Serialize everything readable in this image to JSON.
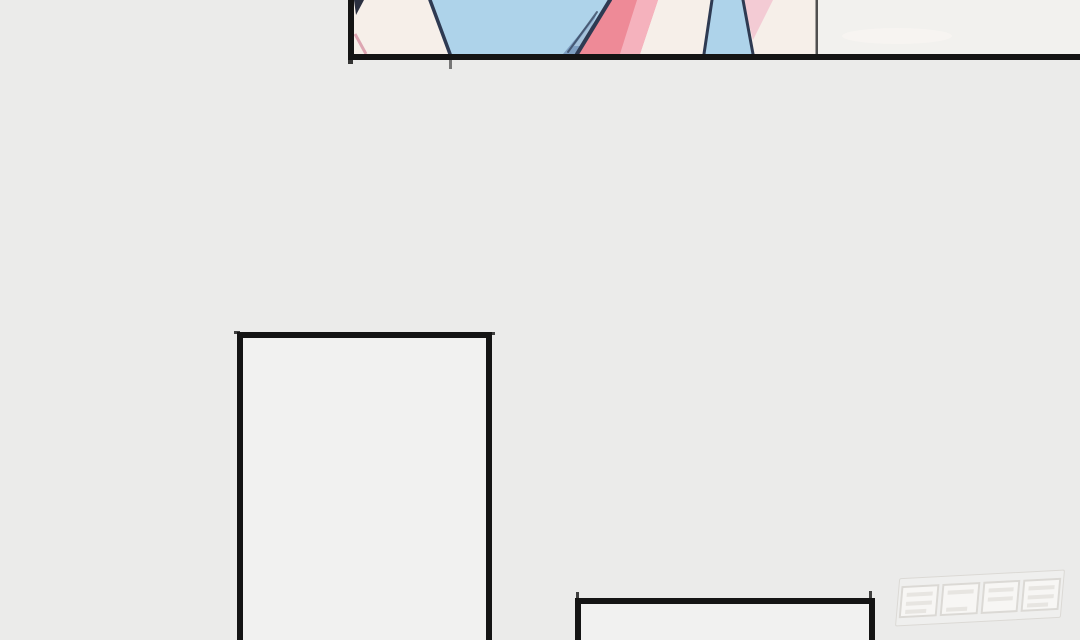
{
  "meta": {
    "description": "Vertical-scroll comic (webtoon) page segment; no readable UI text on screen",
    "visible_text": "none"
  },
  "panels": [
    {
      "id": "top",
      "kind": "artwork-cropped",
      "content": "bottom edge of an illustration: pale cream/skin areas, light-blue fabric trapezoids with dark navy outlines, salmon-pink stripe, pale-pink sliver, thin vertical line, off-white right section"
    },
    {
      "id": "middle-left",
      "kind": "empty-panel",
      "content": "blank interior, cut off at page bottom"
    },
    {
      "id": "bottom-center",
      "kind": "empty-panel",
      "content": "blank interior, cut off at page bottom"
    }
  ],
  "watermark": {
    "glyph_count": 4,
    "legible": false,
    "style": "faint outlined blocky logo, slanted, bottom-right"
  },
  "theme": {
    "colors": {
      "bg": "#ebebea",
      "panelFill": "#f1f1f0",
      "ink": "#141414",
      "inkSoft": "#505050",
      "cream": "#f6efe9",
      "offwhite": "#f2f1ee",
      "blue": "#aed3ea",
      "steelBlue": "#7e9fc2",
      "steelLight": "#a9c5de",
      "navy": "#2e3a52",
      "pink": "#ee8a97",
      "pinkLight": "#f6b9c3",
      "pinkPale": "#f3cbd4",
      "pinkLine": "#dda6b2",
      "wedge": "#2b3040",
      "smudge": "#f7f5f1",
      "wmLine": "#d6d3ce",
      "wmFill": "#fbfaf8",
      "wmBar": "#e6e3de"
    }
  }
}
